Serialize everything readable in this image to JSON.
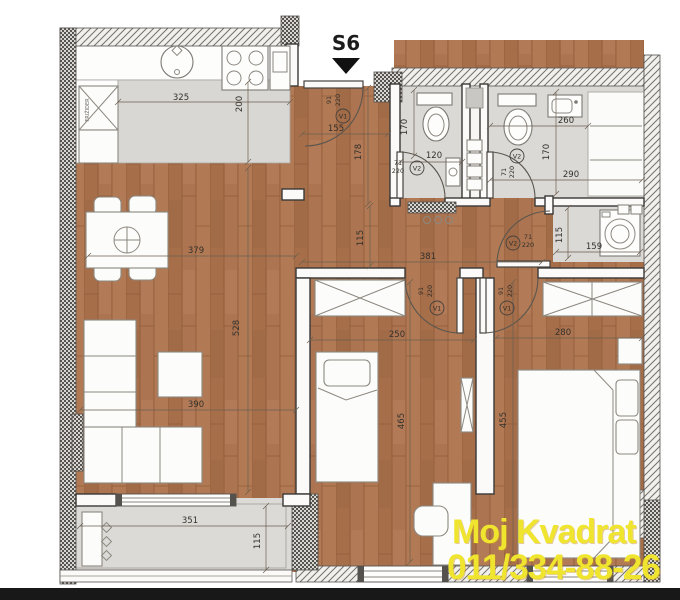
{
  "unit": {
    "label": "S6"
  },
  "watermark": {
    "line1": "Moj Kvadrat",
    "line2": "011/334-88-26",
    "color": "#f0e52e"
  },
  "colors": {
    "wood": "#ac7450",
    "floor_gray": "#dbd9d5",
    "watermark": "#f0e52e"
  },
  "dims": {
    "kitchen_width": "325",
    "kitchen_depth": "200",
    "hall_entry_width": "155",
    "hall_entry_depth": "178",
    "hall_depth": "115",
    "corridor_width": "381",
    "bath1_depth": "170",
    "bath1_width": "120",
    "bath2_top_width": "260",
    "bath2_depth": "170",
    "bath2_width": "290",
    "laundry_depth": "115",
    "laundry_width": "159",
    "living_width": "379",
    "living_depth": "528",
    "living_width2": "390",
    "bedroom1_width": "250",
    "bedroom1_depth": "465",
    "bedroom2_width": "280",
    "bedroom2_depth": "455",
    "terrace_width": "351",
    "terrace_depth": "115"
  },
  "doors": {
    "entrance": {
      "w": "91",
      "h": "220",
      "tag": "V1"
    },
    "bedroom1": {
      "w": "91",
      "h": "220",
      "tag": "V1"
    },
    "bedroom2": {
      "w": "91",
      "h": "220",
      "tag": "V1"
    },
    "bath1": {
      "w": "71",
      "h": "220",
      "tag": "V2"
    },
    "bath2": {
      "w": "71",
      "h": "220",
      "tag": "V2"
    },
    "laundry": {
      "w": "71",
      "h": "220",
      "tag": "V2"
    }
  },
  "notes": {
    "fridge": "FRIŽIDER"
  }
}
